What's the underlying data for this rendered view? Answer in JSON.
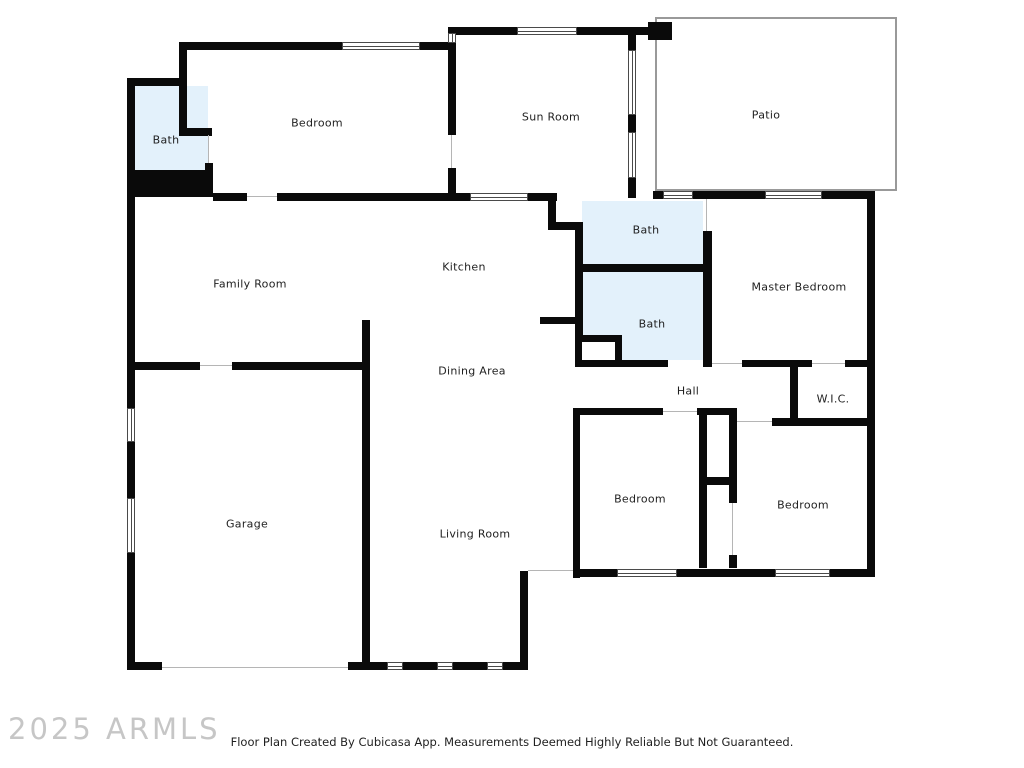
{
  "watermark": "2025 ARMLS",
  "footer": {
    "caption": "Floor Plan Created By Cubicasa App. Measurements Deemed Highly Reliable But Not Guaranteed."
  },
  "rooms": {
    "bath_top_left": {
      "label": "Bath"
    },
    "bedroom_top": {
      "label": "Bedroom"
    },
    "sun_room": {
      "label": "Sun Room"
    },
    "patio": {
      "label": "Patio"
    },
    "bath_upper": {
      "label": "Bath"
    },
    "bath_lower": {
      "label": "Bath"
    },
    "master_bedroom": {
      "label": "Master Bedroom"
    },
    "family_room": {
      "label": "Family Room"
    },
    "kitchen": {
      "label": "Kitchen"
    },
    "dining_area": {
      "label": "Dining Area"
    },
    "hall": {
      "label": "Hall"
    },
    "wic": {
      "label": "W.I.C."
    },
    "garage": {
      "label": "Garage"
    },
    "living_room": {
      "label": "Living Room"
    },
    "bedroom_left": {
      "label": "Bedroom"
    },
    "bedroom_right": {
      "label": "Bedroom"
    }
  },
  "colors": {
    "wall": "#0a0a0a",
    "bath_fill": "#e3f1fb",
    "patio_outline": "#999999",
    "door_line": "#b5b5b5",
    "watermark_text": "#c6c6c6",
    "label_text": "#1f1f1f"
  }
}
